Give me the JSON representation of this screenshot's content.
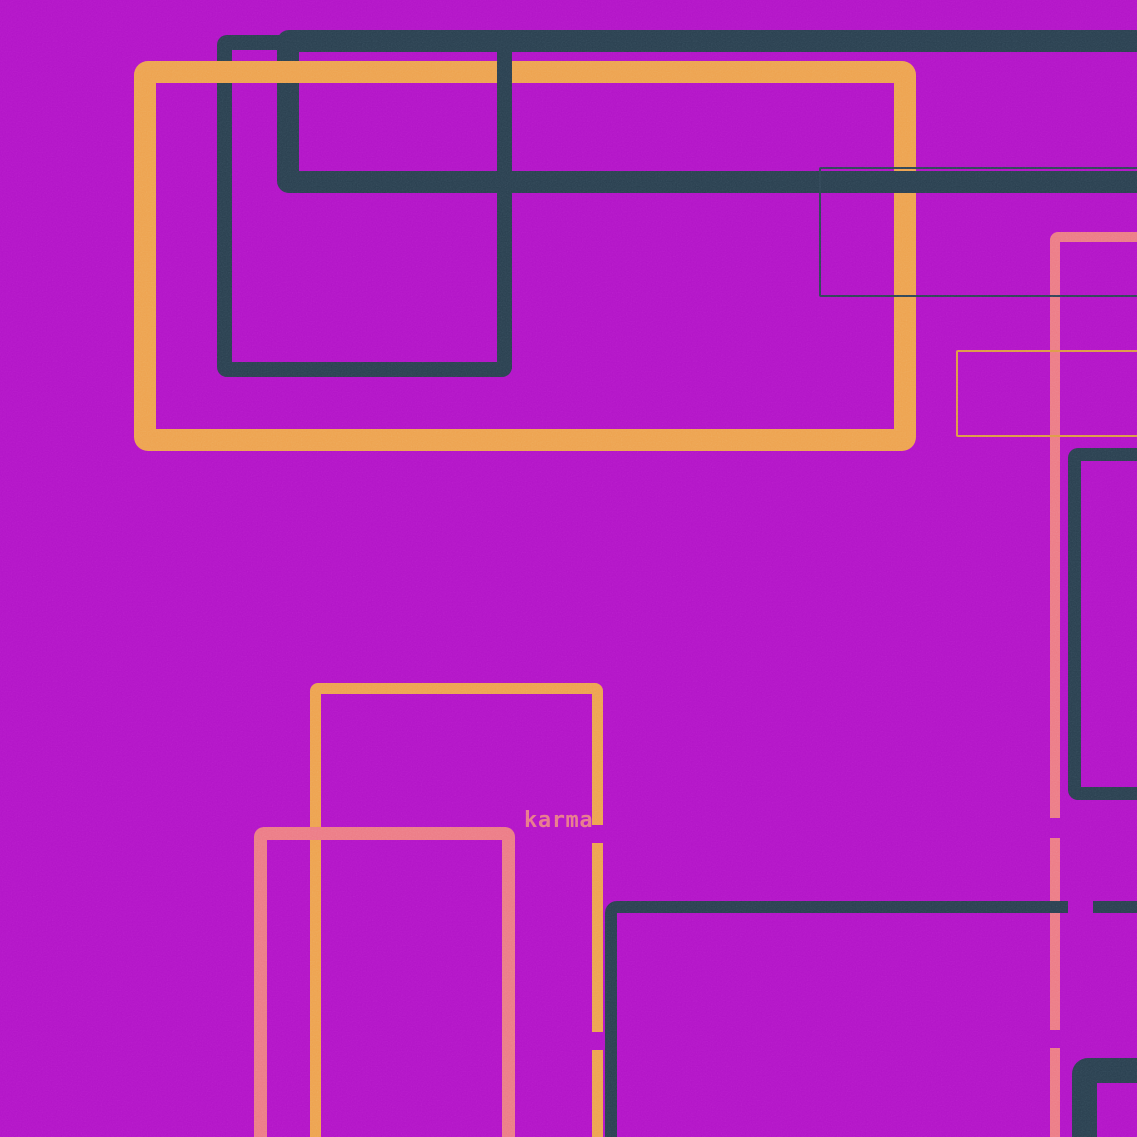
{
  "canvas": {
    "width": 1137,
    "height": 1137
  },
  "colors": {
    "bg": "#b214c7",
    "orange": "#eda24e",
    "navy": "#293f4f",
    "pink": "#ec7b85",
    "thin_orange": "#dd9a44",
    "thin_navy": "#2e4455",
    "label": "#e8798b"
  },
  "label": {
    "text": "karma",
    "x": 524,
    "y": 810,
    "size": 22,
    "color_key": "label"
  },
  "shapes": [
    {
      "name": "navy-rect-top-left",
      "type": "outline",
      "x": 217,
      "y": 35,
      "w": 295,
      "h": 342,
      "border": 15,
      "radius": 10,
      "color_key": "navy",
      "z": 1
    },
    {
      "name": "navy-band-top",
      "type": "outline",
      "x": 277,
      "y": 30,
      "w": 900,
      "h": 163,
      "border": 22,
      "radius": 12,
      "color_key": "navy",
      "z": 1
    },
    {
      "name": "orange-rect-large",
      "type": "outline",
      "x": 134,
      "y": 61,
      "w": 782,
      "h": 390,
      "border": 22,
      "radius": 14,
      "color_key": "orange",
      "z": 2
    },
    {
      "name": "navy-rect-top-left-right-edge",
      "type": "bar",
      "x": 497,
      "y": 43,
      "w": 15,
      "h": 326,
      "color_key": "navy",
      "z": 3
    },
    {
      "name": "navy-band-bottom-overlay",
      "type": "bar",
      "x": 600,
      "y": 171,
      "w": 537,
      "h": 22,
      "color_key": "navy",
      "z": 3
    },
    {
      "name": "orange-rect-tall",
      "type": "outline",
      "x": 310,
      "y": 683,
      "w": 293,
      "h": 470,
      "border": 11,
      "radius": 8,
      "color_key": "orange",
      "z": 3
    },
    {
      "name": "pink-rect-right",
      "type": "outline",
      "x": 1050,
      "y": 232,
      "w": 140,
      "h": 960,
      "border": 10,
      "radius": 8,
      "color_key": "pink",
      "z": 4
    },
    {
      "name": "pink-rect-bottom-left",
      "type": "outline",
      "x": 254,
      "y": 827,
      "w": 261,
      "h": 330,
      "border": 13,
      "radius": 10,
      "color_key": "pink",
      "z": 4
    },
    {
      "name": "navy-rect-right",
      "type": "outline",
      "x": 1068,
      "y": 448,
      "w": 120,
      "h": 352,
      "border": 13,
      "radius": 10,
      "color_key": "navy",
      "z": 4
    },
    {
      "name": "navy-thin-rect",
      "type": "outline",
      "x": 819,
      "y": 167,
      "w": 370,
      "h": 130,
      "border": 2,
      "radius": 2,
      "color_key": "thin_navy",
      "z": 5
    },
    {
      "name": "orange-thin-rect",
      "type": "outline",
      "x": 956,
      "y": 350,
      "w": 235,
      "h": 87,
      "border": 2,
      "radius": 2,
      "color_key": "thin_orange",
      "z": 5
    },
    {
      "name": "navy-rect-bottom",
      "type": "outline",
      "x": 605,
      "y": 901,
      "w": 590,
      "h": 290,
      "border": 12,
      "radius": 12,
      "color_key": "navy",
      "z": 5
    },
    {
      "name": "navy-rect-bottom-right",
      "type": "outline",
      "x": 1072,
      "y": 1058,
      "w": 120,
      "h": 130,
      "border": 25,
      "radius": 16,
      "color_key": "navy",
      "z": 5
    },
    {
      "name": "bg-patch-orange-gap-top",
      "type": "patch",
      "x": 590,
      "y": 825,
      "w": 16,
      "h": 18,
      "color_key": "bg",
      "z": 6
    },
    {
      "name": "bg-patch-orange-gap-bottom",
      "type": "patch",
      "x": 590,
      "y": 1032,
      "w": 14,
      "h": 18,
      "color_key": "bg",
      "z": 6
    },
    {
      "name": "bg-patch-pink-gap-top",
      "type": "patch",
      "x": 1046,
      "y": 818,
      "w": 18,
      "h": 20,
      "color_key": "bg",
      "z": 6
    },
    {
      "name": "bg-patch-pink-gap-bottom",
      "type": "patch",
      "x": 1046,
      "y": 1030,
      "w": 18,
      "h": 18,
      "color_key": "bg",
      "z": 6
    },
    {
      "name": "bg-patch-navy-bar-gap",
      "type": "patch",
      "x": 1068,
      "y": 897,
      "w": 25,
      "h": 18,
      "color_key": "bg",
      "z": 6
    }
  ]
}
